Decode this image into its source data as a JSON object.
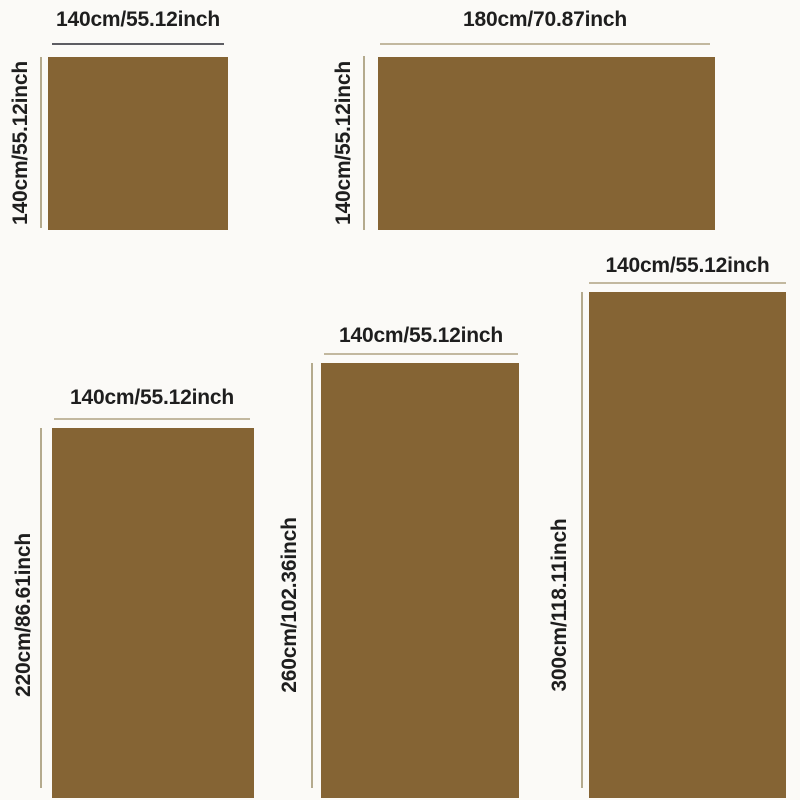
{
  "page": {
    "background_color": "#fbfaf7",
    "label_text_color": "#1e1e1e",
    "swatch_color": "#856434",
    "measure_line_dark_color": "#5d5d63",
    "measure_line_tan_color": "#c2b89f"
  },
  "diagrams": [
    {
      "width_label": "140cm/55.12inch",
      "height_label": "140cm/55.12inch"
    },
    {
      "width_label": "180cm/70.87inch",
      "height_label": "140cm/55.12inch"
    },
    {
      "width_label": "140cm/55.12inch",
      "height_label": "220cm/86.61inch"
    },
    {
      "width_label": "140cm/55.12inch",
      "height_label": "260cm/102.36inch"
    },
    {
      "width_label": "140cm/55.12inch",
      "height_label": "300cm/118.11inch"
    }
  ]
}
